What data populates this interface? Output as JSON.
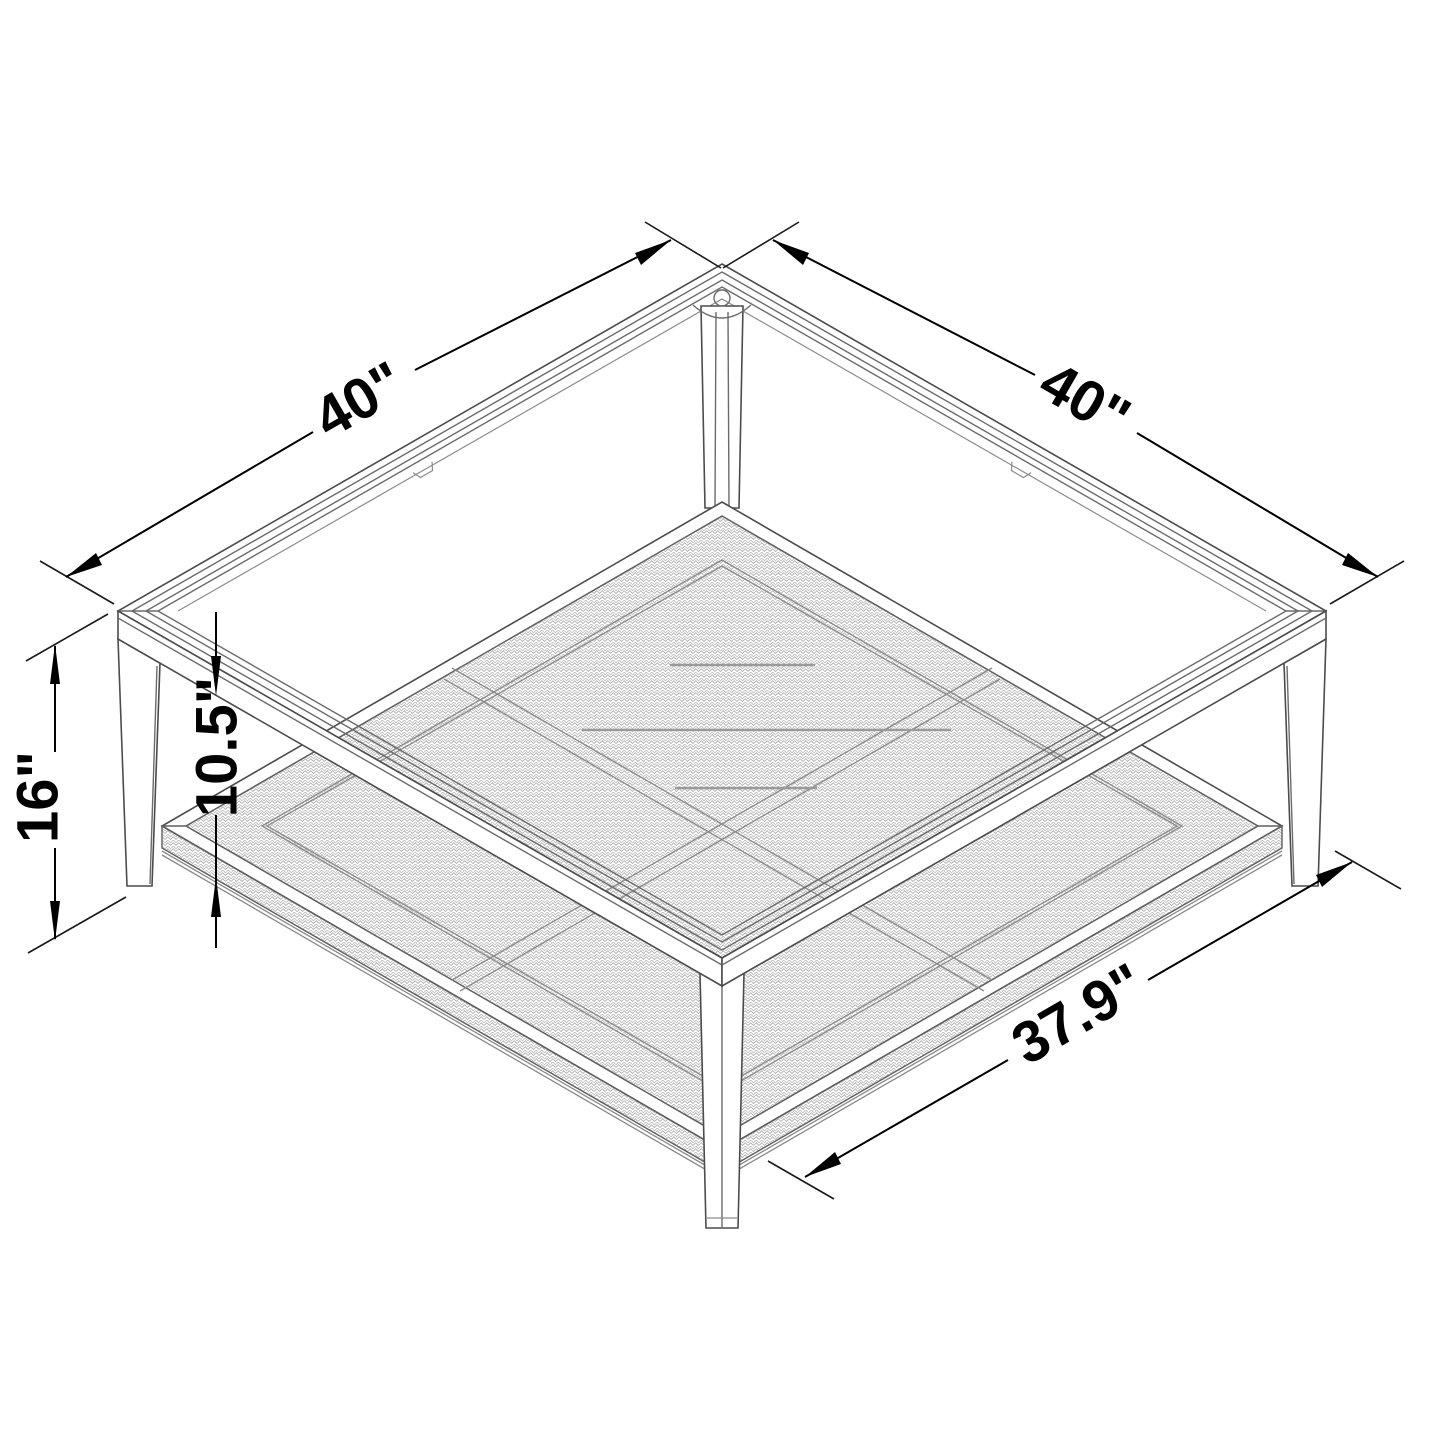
{
  "diagram": {
    "dimension_labels": {
      "top_left_edge": "40\"",
      "top_right_edge": "40\"",
      "overall_height": "16\"",
      "shelf_clearance": "10.5\"",
      "shelf_depth": "37.9\""
    },
    "colors": {
      "background": "#ffffff",
      "structure_line": "#4c4c4c",
      "dimension_line": "#000000",
      "weave_texture": "#b3b3b3"
    }
  }
}
